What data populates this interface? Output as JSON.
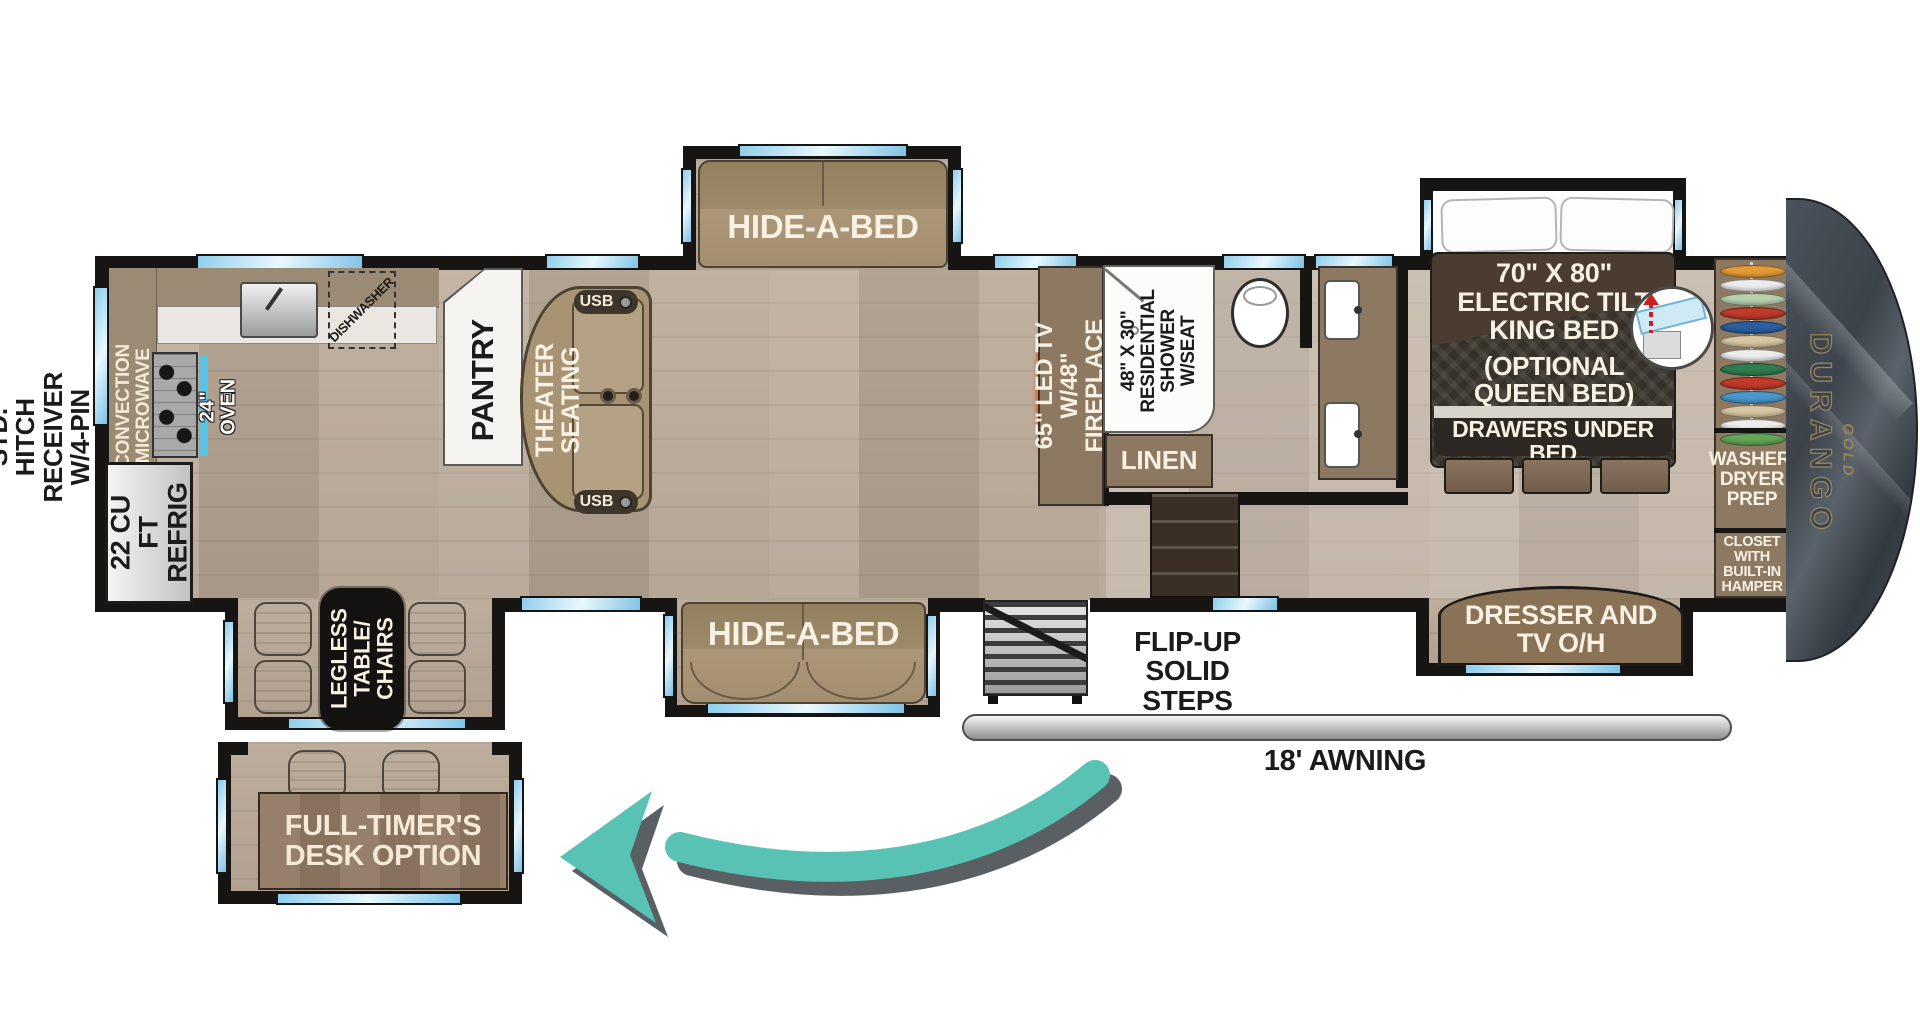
{
  "exterior": {
    "hitch_label": "STD. HITCH RECEIVER\nW/4-PIN HARNESS",
    "awning_label": "18' AWNING",
    "steps_label": "FLIP-UP\nSOLID STEPS",
    "brand": "DURANGO",
    "brand_sub": "GOLD"
  },
  "kitchen": {
    "microwave_label": "CONVECTION\nMICROWAVE",
    "oven_label": "24\" OVEN",
    "fridge_label": "22 CU FT\nREFRIG",
    "dishwasher_label": "DISHWASHER",
    "pantry_label": "PANTRY"
  },
  "living": {
    "theater_label": "THEATER\nSEATING",
    "usb_label": "USB",
    "sofa_top_label": "HIDE-A-BED",
    "sofa_bottom_label": "HIDE-A-BED",
    "dinette_label": "LEGLESS\nTABLE/\nCHAIRS",
    "fireplace_label": "65\" LED TV\nW/48\" FIREPLACE"
  },
  "bathroom": {
    "shower_label": "48\" X 30\"\nRESIDENTIAL\nSHOWER W/SEAT",
    "linen_label": "LINEN"
  },
  "bedroom": {
    "bed_label": "70\" X 80\"\nELECTRIC TILT\nKING BED",
    "bed_option_label": "(OPTIONAL\nQUEEN BED)",
    "bed_drawers_label": "DRAWERS UNDER BED",
    "washer_label": "WASHER/\nDRYER\nPREP",
    "closet_label": "CLOSET\nWITH\nBUILT-IN\nHAMPER",
    "dresser_label": "DRESSER AND\nTV O/H",
    "hanger_colors": [
      "#e39b35",
      "#ececec",
      "#b9cfae",
      "#bf3a2b",
      "#2b5f9e",
      "#d7c6a3",
      "#ececec",
      "#2f7d4f",
      "#c23b2a",
      "#4a97cc",
      "#d7c6a3",
      "#ececec",
      "#63a556"
    ]
  },
  "desk_option": {
    "label": "FULL-TIMER'S\nDESK OPTION"
  },
  "colors": {
    "arrow_teal": "#58c2b5",
    "arrow_shadow": "#5a5f63",
    "window_blue": "#a9daf2",
    "wall_black": "#161514"
  }
}
